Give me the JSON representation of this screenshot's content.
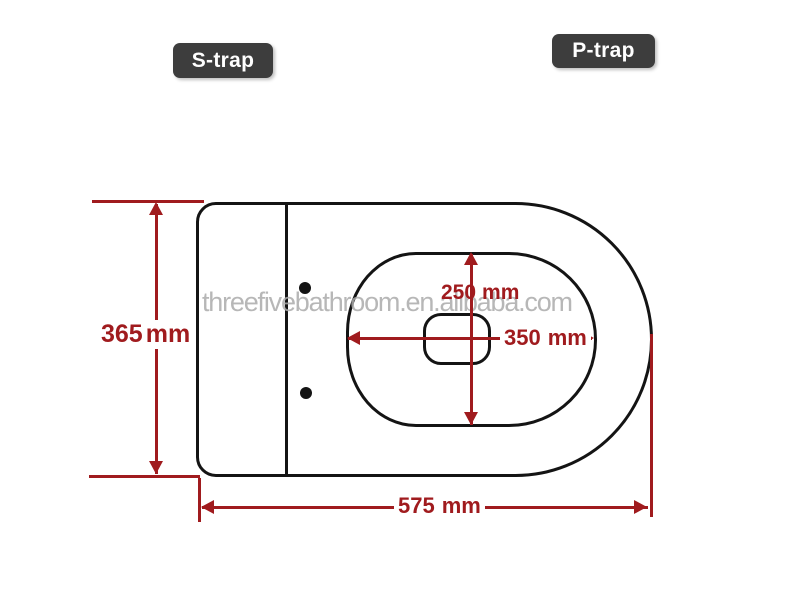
{
  "diagram": {
    "badges": {
      "s_trap": "S-trap",
      "p_trap": "P-trap"
    },
    "watermark": "threefivebathroom.en.alibaba.com",
    "dimensions": {
      "overall_width": {
        "value": "365",
        "unit": "mm"
      },
      "opening_width": {
        "value": "250",
        "unit": "mm"
      },
      "opening_length": {
        "value": "350",
        "unit": "mm"
      },
      "overall_length": {
        "value": "575",
        "unit": "mm"
      }
    },
    "colors": {
      "red": "#a01b1e",
      "badge": "#3d3d3d",
      "line": "#141414",
      "watermark": "#ababab",
      "bg": "#ffffff"
    }
  }
}
